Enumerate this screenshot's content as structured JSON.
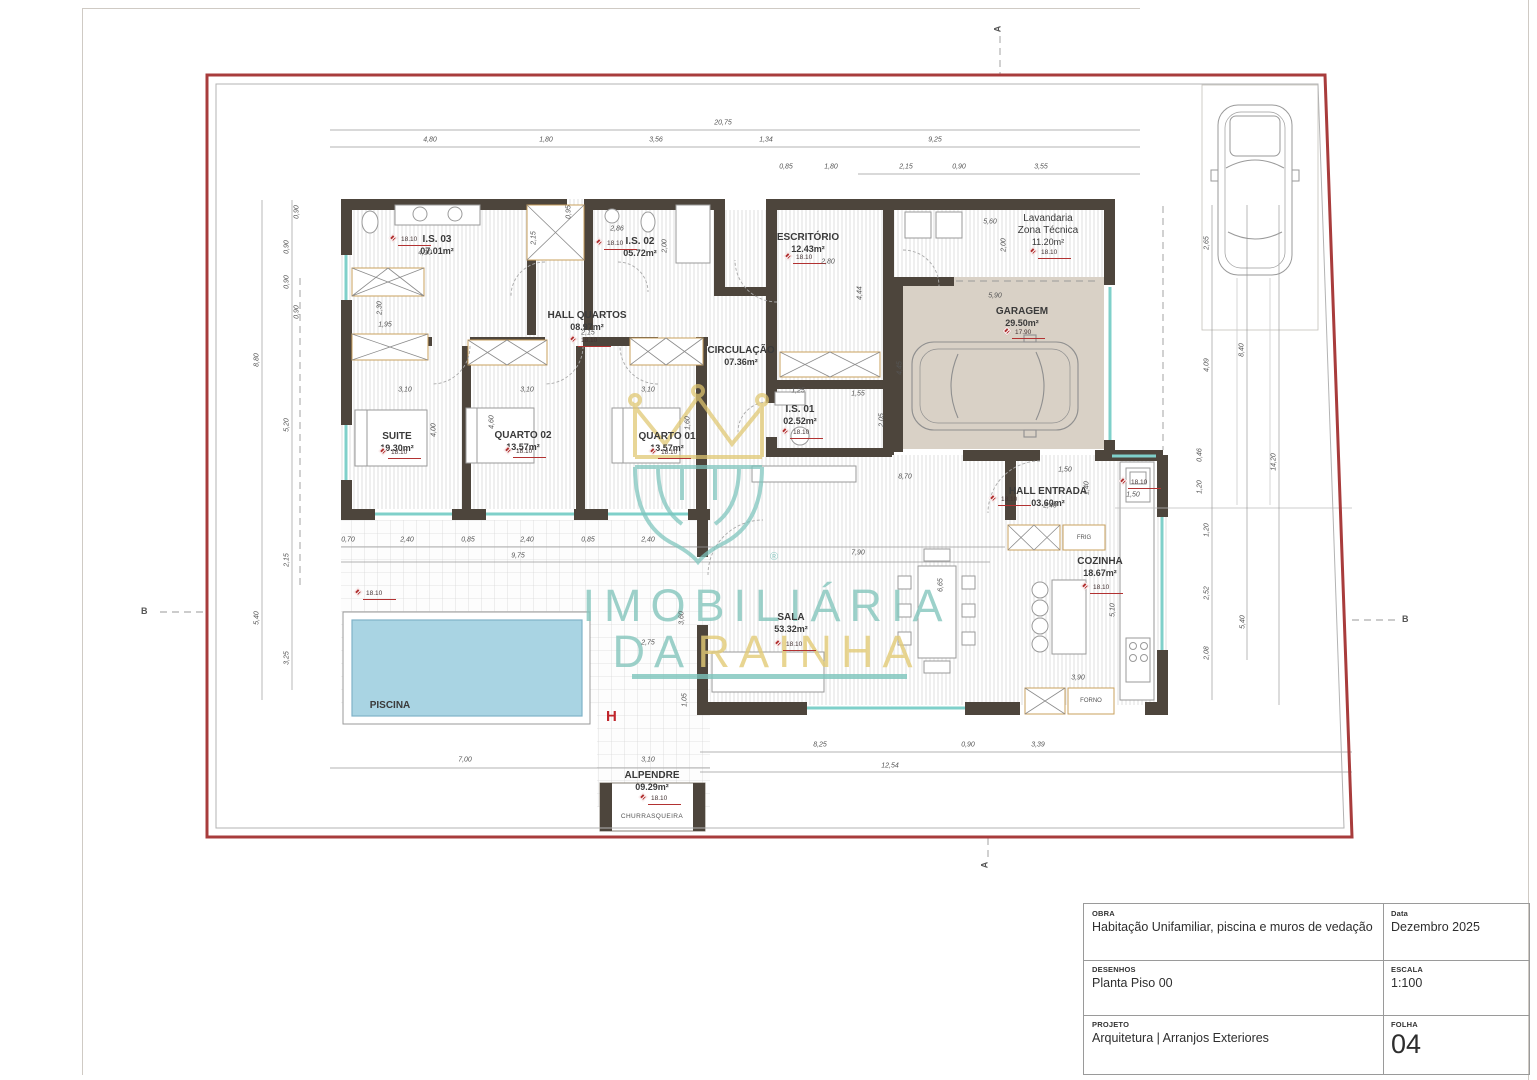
{
  "drawing": {
    "watermark": {
      "line1": "IMOBILIÁRIA",
      "line2_word1": "DA",
      "line2_word2": "RAINHA",
      "registered": "®"
    },
    "levels": {
      "main": "18.10",
      "garage": "17.90"
    },
    "markers": {
      "a_top": "A",
      "a_bottom": "A",
      "b_left": "B",
      "b_right": "B",
      "h": "H"
    },
    "rooms": {
      "suite": {
        "name": "SUITE",
        "area": "19.30m²"
      },
      "quarto02": {
        "name": "QUARTO 02",
        "area": "13.57m²"
      },
      "quarto01": {
        "name": "QUARTO 01",
        "area": "13.57m²"
      },
      "is03": {
        "name": "I.S. 03",
        "area": "07.01m²"
      },
      "is02": {
        "name": "I.S. 02",
        "area": "05.72m²"
      },
      "is01": {
        "name": "I.S. 01",
        "area": "02.52m²"
      },
      "hallquartos": {
        "name": "HALL QUARTOS",
        "area": "08.97m²"
      },
      "circulacao": {
        "name": "CIRCULAÇÃO",
        "area": "07.36m²"
      },
      "escritorio": {
        "name": "ESCRITÓRIO",
        "area": "12.43m²"
      },
      "lavandaria": {
        "name": "Lavandaria",
        "name2": "Zona Técnica",
        "area": "11.20m²"
      },
      "garagem": {
        "name": "GARAGEM",
        "area": "29.50m²"
      },
      "hallentrada": {
        "name": "HALL ENTRADA",
        "area": "03.60m²"
      },
      "cozinha": {
        "name": "COZINHA",
        "area": "18.67m²"
      },
      "sala": {
        "name": "SALA",
        "area": "53.32m²"
      },
      "alpendre": {
        "name": "ALPENDRE",
        "area": "09.29m²"
      },
      "piscina": {
        "name": "PISCINA"
      },
      "churrasqueira": {
        "name": "CHURRASQUEIRA"
      }
    },
    "appliances": {
      "frig": "FRIG",
      "forno": "FORNO"
    },
    "dims": [
      "20,75",
      "4,80",
      "1,80",
      "3,56",
      "1,34",
      "9,25",
      "0,85",
      "1,80",
      "2,15",
      "0,90",
      "3,55",
      "8,80",
      "5,20",
      "2,15",
      "5,40",
      "3,25",
      "0,90",
      "0,90",
      "0,90",
      "0,90",
      "8,40",
      "4,09",
      "0,46",
      "1,20",
      "14,20",
      "1,20",
      "2,52",
      "2,08",
      "5,40",
      "8,25",
      "0,90",
      "3,39",
      "12,54",
      "3,10",
      "7,00",
      "0,70",
      "2,40",
      "0,85",
      "2,40",
      "0,85",
      "2,40",
      "9,75",
      "3,10",
      "3,10",
      "3,10",
      "4,10",
      "2,86",
      "2,00",
      "2,15",
      "0,95",
      "1,95",
      "2,30",
      "2,15",
      "2,80",
      "4,44",
      "5,60",
      "2,00",
      "5,90",
      "4,45",
      "1,25",
      "1,55",
      "2,05",
      "7,90",
      "8,70",
      "1,50",
      "2,40",
      "1,40",
      "1,50",
      "6,65",
      "5,10",
      "3,90",
      "2,75",
      "3,60",
      "1,05",
      "2,65",
      "1,60",
      "4,60",
      "4,00"
    ]
  },
  "titleblock": {
    "obra_label": "OBRA",
    "obra": "Habitação Unifamiliar, piscina e muros de vedação",
    "data_label": "Data",
    "data": "Dezembro 2025",
    "desenhos_label": "DESENHOS",
    "desenhos": "Planta Piso 00",
    "escala_label": "ESCALA",
    "escala": "1:100",
    "projeto_label": "PROJETO",
    "projeto": "Arquitetura | Arranjos Exteriores",
    "folha_label": "FOLHA",
    "folha": "04"
  }
}
